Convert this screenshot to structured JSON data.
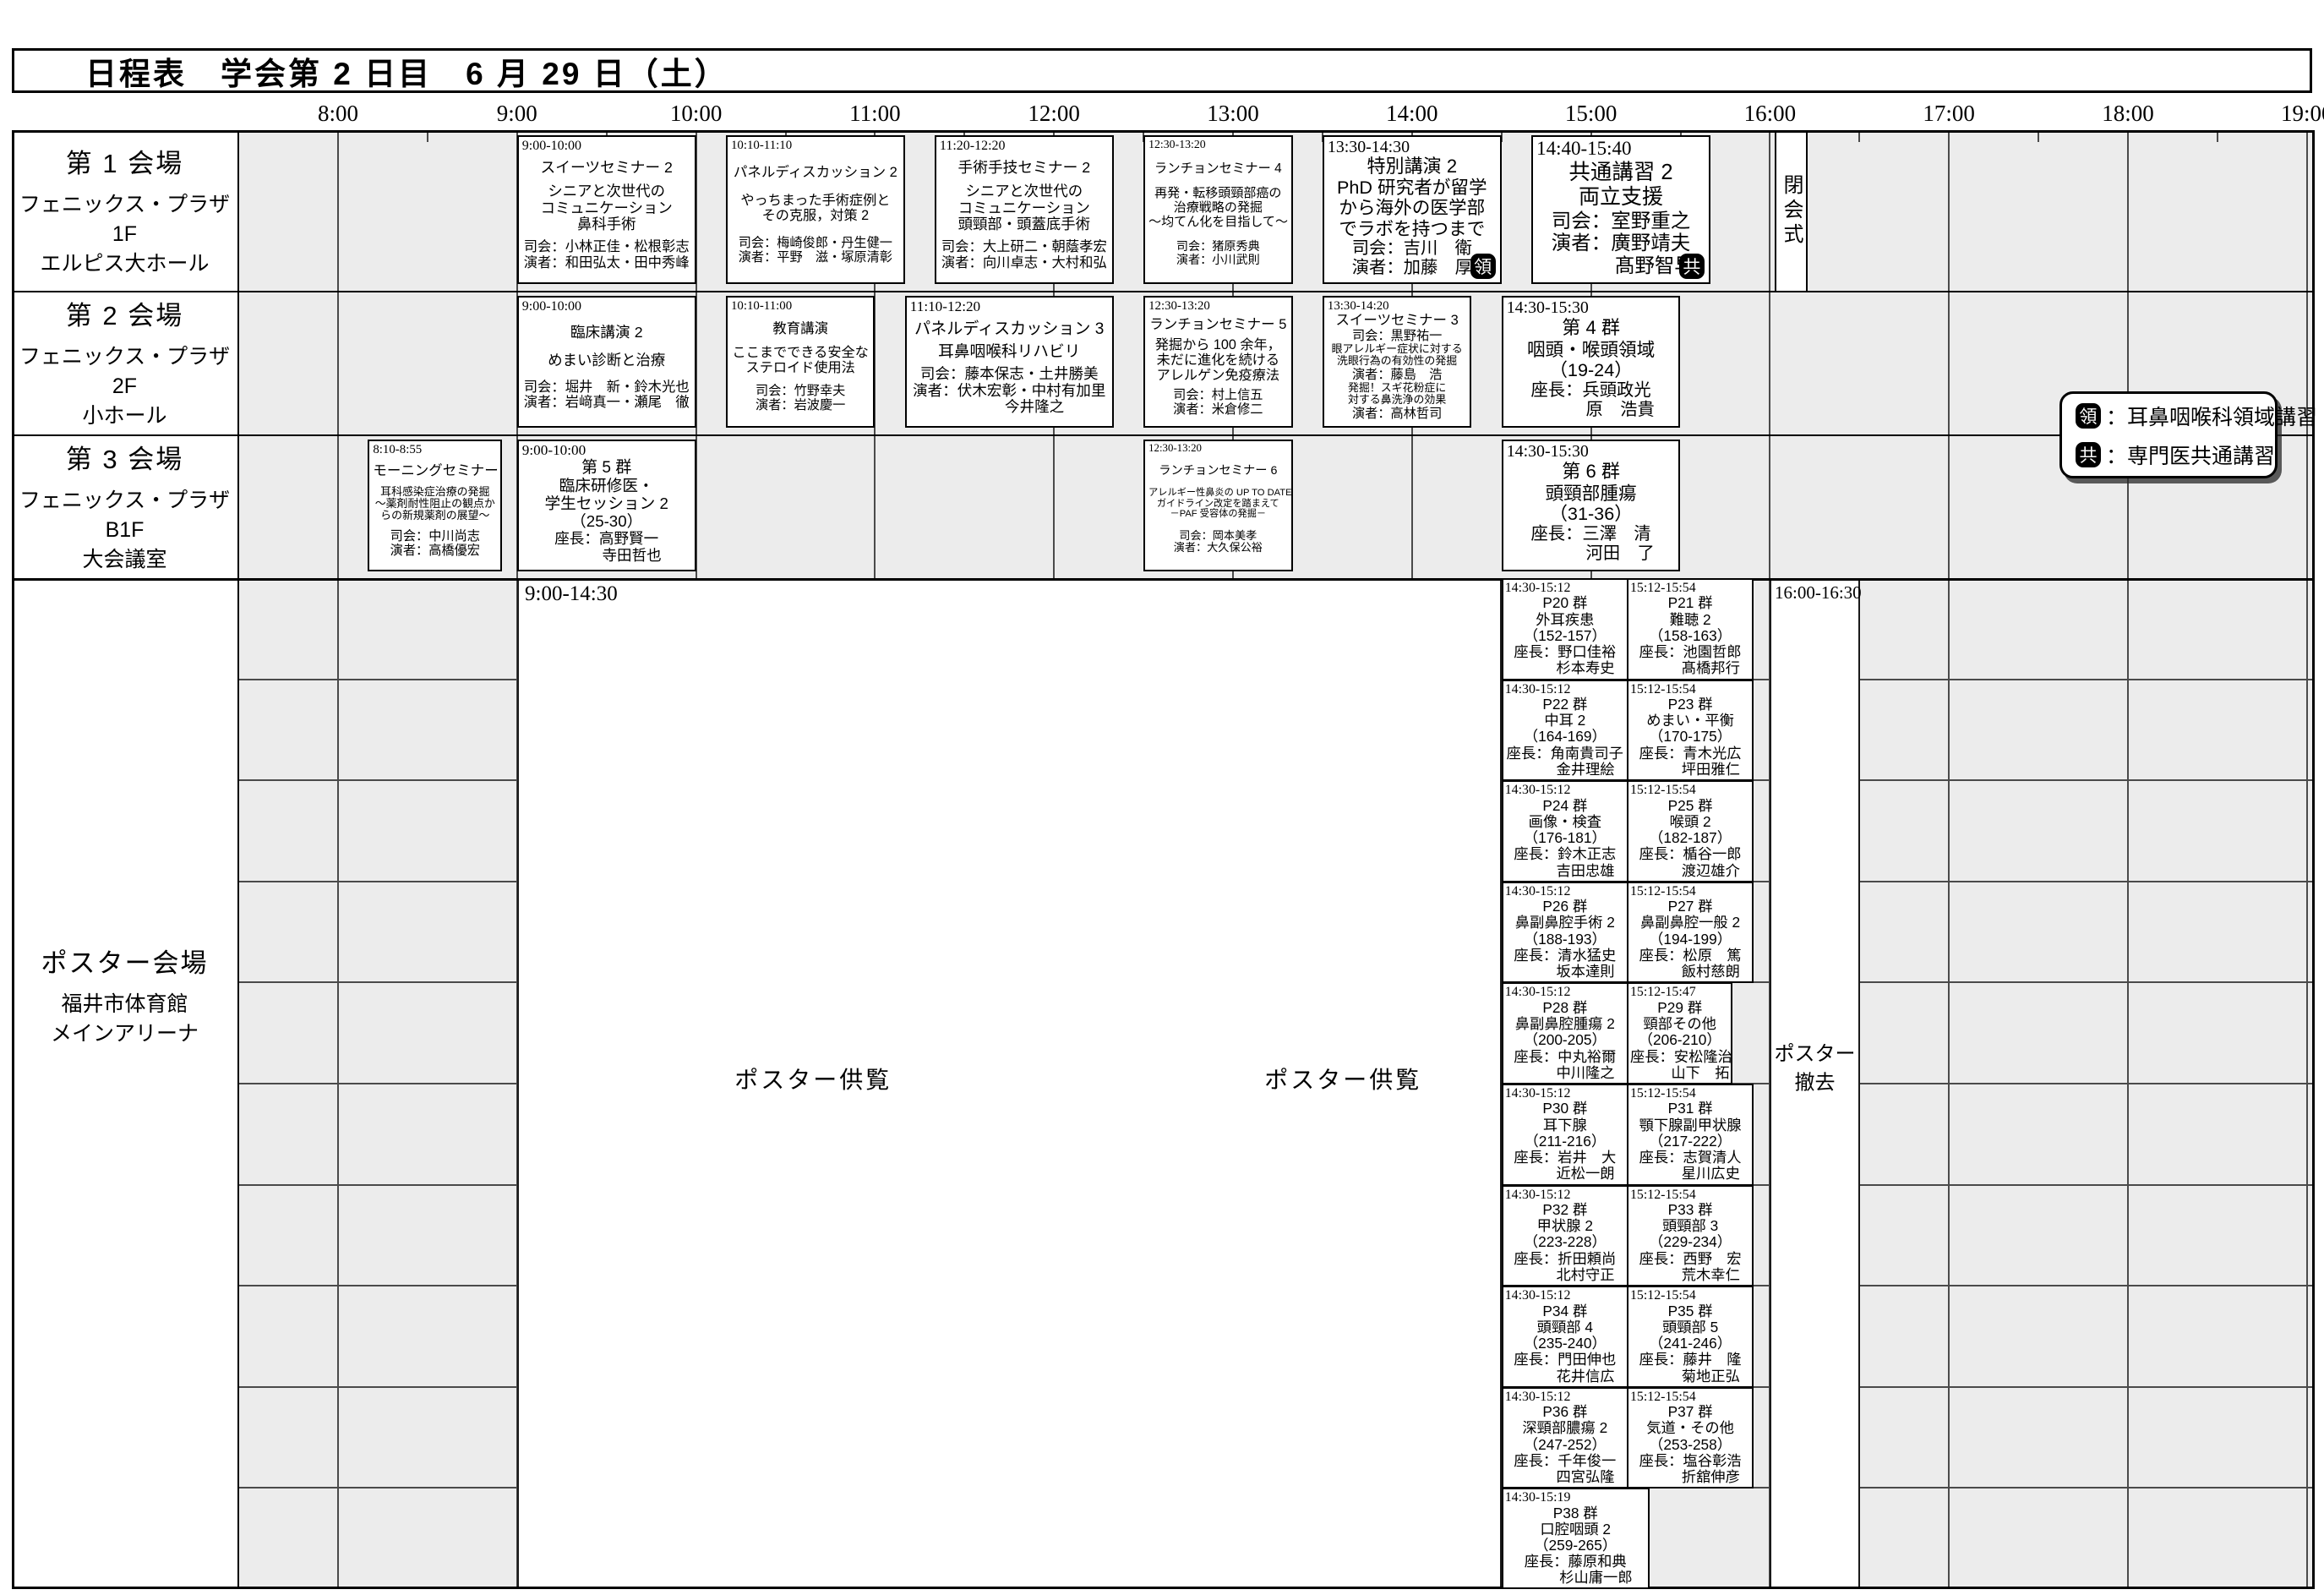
{
  "title": "日程表　学会第 2 日目　6 月 29 日（土）",
  "time_labels": [
    "8:00",
    "9:00",
    "10:00",
    "11:00",
    "12:00",
    "13:00",
    "14:00",
    "15:00",
    "16:00",
    "17:00",
    "18:00",
    "19:00"
  ],
  "closing": "閉会式",
  "legend": {
    "items": [
      {
        "badge": "領",
        "text": "：耳鼻咽喉科領域講習"
      },
      {
        "badge": "共",
        "text": "：専門医共通講習"
      }
    ]
  },
  "venues": [
    {
      "name": "第 1 会場",
      "floor": "フェニックス・プラザ 1F",
      "hall": "エルピス大ホール",
      "sessions": [
        {
          "time": "9:00-10:00",
          "start": 9.0,
          "end": 10.0,
          "lines": [
            {
              "t": "スイーツセミナー 2",
              "c": "name"
            },
            {
              "t": "シニアと次世代の",
              "c": "body"
            },
            {
              "t": "コミュニケーション",
              "c": "body"
            },
            {
              "t": "鼻科手術",
              "c": "body"
            },
            {
              "t": "司会：小林正佳・松根彰志",
              "c": "people"
            },
            {
              "t": "演者：和田弘太・田中秀峰",
              "c": "people"
            }
          ]
        },
        {
          "time": "10:10-11:10",
          "start": 10.167,
          "end": 11.167,
          "lines": [
            {
              "t": "パネルディスカッション 2",
              "c": "name"
            },
            {
              "t": "やっちまった手術症例と",
              "c": "body"
            },
            {
              "t": "その克服，対策 2",
              "c": "body"
            },
            {
              "t": "司会：梅崎俊郎・丹生健一",
              "c": "people"
            },
            {
              "t": "演者：平野　滋・塚原清彰",
              "c": "people"
            }
          ]
        },
        {
          "time": "11:20-12:20",
          "start": 11.333,
          "end": 12.333,
          "lines": [
            {
              "t": "手術手技セミナー 2",
              "c": "name"
            },
            {
              "t": "シニアと次世代の",
              "c": "body"
            },
            {
              "t": "コミュニケーション",
              "c": "body"
            },
            {
              "t": "頭頸部・頭蓋底手術",
              "c": "body"
            },
            {
              "t": "司会：大上研二・朝蔭孝宏",
              "c": "people"
            },
            {
              "t": "演者：向川卓志・大村和弘",
              "c": "people"
            }
          ]
        },
        {
          "time": "12:30-13:20",
          "start": 12.5,
          "end": 13.333,
          "lines": [
            {
              "t": "ランチョンセミナー 4",
              "c": "name"
            },
            {
              "t": "再発・転移頭頸部癌の",
              "c": "body"
            },
            {
              "t": "治療戦略の発掘",
              "c": "body"
            },
            {
              "t": "～均てん化を目指して～",
              "c": "body"
            },
            {
              "t": "司会：猪原秀典",
              "c": "people"
            },
            {
              "t": "演者：小川武則",
              "c": "people"
            }
          ]
        },
        {
          "time": "13:30-14:30",
          "start": 13.5,
          "end": 14.5,
          "badge": "領",
          "lines": [
            {
              "t": "特別講演 2",
              "c": "name"
            },
            {
              "t": "PhD 研究者が留学",
              "c": "body"
            },
            {
              "t": "から海外の医学部",
              "c": "body"
            },
            {
              "t": "でラボを持つまで",
              "c": "body"
            },
            {
              "t": "司会：吉川　衛",
              "c": "people"
            },
            {
              "t": "演者：加藤　厚",
              "c": "people"
            }
          ]
        },
        {
          "time": "14:40-15:40",
          "start": 14.667,
          "end": 15.667,
          "badge": "共",
          "lines": [
            {
              "t": "共通講習 2",
              "c": "name"
            },
            {
              "t": "両立支援",
              "c": "body"
            },
            {
              "t": "司会：室野重之",
              "c": "people"
            },
            {
              "t": "演者：廣野靖夫",
              "c": "people"
            },
            {
              "t": "髙野智早",
              "c": "p2"
            }
          ]
        }
      ]
    },
    {
      "name": "第 2 会場",
      "floor": "フェニックス・プラザ 2F",
      "hall": "小ホール",
      "sessions": [
        {
          "time": "9:00-10:00",
          "start": 9.0,
          "end": 10.0,
          "lines": [
            {
              "t": "臨床講演 2",
              "c": "name"
            },
            {
              "t": "めまい診断と治療",
              "c": "body"
            },
            {
              "t": "司会：堀井　新・鈴木光也",
              "c": "people"
            },
            {
              "t": "演者：岩﨑真一・瀬尾　徹",
              "c": "people"
            }
          ]
        },
        {
          "time": "10:10-11:00",
          "start": 10.167,
          "end": 11.0,
          "lines": [
            {
              "t": "教育講演",
              "c": "name"
            },
            {
              "t": "ここまでできる安全な",
              "c": "body"
            },
            {
              "t": "ステロイド使用法",
              "c": "body"
            },
            {
              "t": "司会：竹野幸夫",
              "c": "people"
            },
            {
              "t": "演者：岩波慶一",
              "c": "people"
            }
          ]
        },
        {
          "time": "11:10-12:20",
          "start": 11.167,
          "end": 12.333,
          "lines": [
            {
              "t": "パネルディスカッション 3",
              "c": "name"
            },
            {
              "t": "耳鼻咽喉科リハビリ",
              "c": "body"
            },
            {
              "t": "司会：藤本保志・土井勝美",
              "c": "people"
            },
            {
              "t": "演者：伏木宏彰・中村有加里",
              "c": "people"
            },
            {
              "t": "今井隆之",
              "c": "p2"
            }
          ]
        },
        {
          "time": "12:30-13:20",
          "start": 12.5,
          "end": 13.333,
          "lines": [
            {
              "t": "ランチョンセミナー 5",
              "c": "name"
            },
            {
              "t": "発掘から 100 余年，",
              "c": "body"
            },
            {
              "t": "未だに進化を続ける",
              "c": "body"
            },
            {
              "t": "アレルゲン免疫療法",
              "c": "body"
            },
            {
              "t": "司会：村上信五",
              "c": "people"
            },
            {
              "t": "演者：米倉修二",
              "c": "people"
            }
          ]
        },
        {
          "time": "13:30-14:20",
          "start": 13.5,
          "end": 14.333,
          "lines": [
            {
              "t": "スイーツセミナー 3",
              "c": "name"
            },
            {
              "t": "司会：黒野祐一",
              "c": "people"
            },
            {
              "t": "眼アレルギー症状に対する",
              "c": "small"
            },
            {
              "t": "洗眼行為の有効性の発掘",
              "c": "small"
            },
            {
              "t": "演者：藤島　浩",
              "c": "people"
            },
            {
              "t": "発掘！スギ花粉症に",
              "c": "small"
            },
            {
              "t": "対する鼻洗浄の効果",
              "c": "small"
            },
            {
              "t": "演者：高林哲司",
              "c": "people"
            }
          ]
        },
        {
          "time": "14:30-15:30",
          "start": 14.5,
          "end": 15.5,
          "lines": [
            {
              "t": "第 4 群",
              "c": "name"
            },
            {
              "t": "咽頭・喉頭領域",
              "c": "body"
            },
            {
              "t": "（19-24）",
              "c": "body"
            },
            {
              "t": "座長：兵頭政光",
              "c": "people"
            },
            {
              "t": "原　浩貴",
              "c": "p2"
            }
          ]
        }
      ]
    },
    {
      "name": "第 3 会場",
      "floor": "フェニックス・プラザ B1F",
      "hall": "大会議室",
      "sessions": [
        {
          "time": "8:10-8:55",
          "start": 8.167,
          "end": 8.917,
          "lines": [
            {
              "t": "モーニングセミナー",
              "c": "name"
            },
            {
              "t": "耳科感染症治療の発掘",
              "c": "small"
            },
            {
              "t": "～薬剤耐性阻止の観点か",
              "c": "small"
            },
            {
              "t": "らの新規薬剤の展望～",
              "c": "small"
            },
            {
              "t": "司会：中川尚志",
              "c": "people"
            },
            {
              "t": "演者：高橋優宏",
              "c": "people"
            }
          ]
        },
        {
          "time": "9:00-10:00",
          "start": 9.0,
          "end": 10.0,
          "lines": [
            {
              "t": "第 5 群",
              "c": "name"
            },
            {
              "t": "臨床研修医・",
              "c": "body"
            },
            {
              "t": "学生セッション 2",
              "c": "body"
            },
            {
              "t": "（25-30）",
              "c": "body"
            },
            {
              "t": "座長：高野賢一",
              "c": "people"
            },
            {
              "t": "寺田哲也",
              "c": "p2"
            }
          ]
        },
        {
          "time": "12:30-13:20",
          "start": 12.5,
          "end": 13.333,
          "lines": [
            {
              "t": "ランチョンセミナー 6",
              "c": "name"
            },
            {
              "t": "アレルギー性鼻炎の UP TO DATE",
              "c": "small"
            },
            {
              "t": "ガイドライン改定を踏まえて",
              "c": "small"
            },
            {
              "t": "－PAF 受容体の発掘－",
              "c": "small"
            },
            {
              "t": "司会：岡本美孝",
              "c": "people"
            },
            {
              "t": "演者：大久保公裕",
              "c": "people"
            }
          ]
        },
        {
          "time": "14:30-15:30",
          "start": 14.5,
          "end": 15.5,
          "lines": [
            {
              "t": "第 6 群",
              "c": "name"
            },
            {
              "t": "頭頸部腫瘍",
              "c": "body"
            },
            {
              "t": "（31-36）",
              "c": "body"
            },
            {
              "t": "座長：三澤　清",
              "c": "people"
            },
            {
              "t": "河田　了",
              "c": "p2"
            }
          ]
        }
      ]
    }
  ],
  "poster": {
    "name": "ポスター会場",
    "sub1": "福井市体育館",
    "sub2": "メインアリーナ",
    "viewing": {
      "time": "9:00-14:30",
      "label": "ポスター供覧"
    },
    "removal": {
      "time": "16:00-16:30",
      "label": "ポスター撤去"
    },
    "groups": [
      {
        "time": "14:30-15:12",
        "start": 14.5,
        "end": 15.2,
        "row": 0,
        "lines": [
          "P20 群",
          "外耳疾患",
          "（152-157）",
          "座長：野口佳裕",
          "杉本寿史"
        ]
      },
      {
        "time": "15:12-15:54",
        "start": 15.2,
        "end": 15.9,
        "row": 0,
        "lines": [
          "P21 群",
          "難聴 2",
          "（158-163）",
          "座長：池園哲郎",
          "髙橋邦行"
        ]
      },
      {
        "time": "14:30-15:12",
        "start": 14.5,
        "end": 15.2,
        "row": 1,
        "lines": [
          "P22 群",
          "中耳 2",
          "（164-169）",
          "座長：角南貴司子",
          "金井理絵"
        ]
      },
      {
        "time": "15:12-15:54",
        "start": 15.2,
        "end": 15.9,
        "row": 1,
        "lines": [
          "P23 群",
          "めまい・平衡",
          "（170-175）",
          "座長：青木光広",
          "坪田雅仁"
        ]
      },
      {
        "time": "14:30-15:12",
        "start": 14.5,
        "end": 15.2,
        "row": 2,
        "lines": [
          "P24 群",
          "画像・検査",
          "（176-181）",
          "座長：鈴木正志",
          "吉田忠雄"
        ]
      },
      {
        "time": "15:12-15:54",
        "start": 15.2,
        "end": 15.9,
        "row": 2,
        "lines": [
          "P25 群",
          "喉頭 2",
          "（182-187）",
          "座長：楯谷一郎",
          "渡辺雄介"
        ]
      },
      {
        "time": "14:30-15:12",
        "start": 14.5,
        "end": 15.2,
        "row": 3,
        "lines": [
          "P26 群",
          "鼻副鼻腔手術 2",
          "（188-193）",
          "座長：清水猛史",
          "坂本達則"
        ]
      },
      {
        "time": "15:12-15:54",
        "start": 15.2,
        "end": 15.9,
        "row": 3,
        "lines": [
          "P27 群",
          "鼻副鼻腔一般 2",
          "（194-199）",
          "座長：松原　篤",
          "飯村慈朗"
        ]
      },
      {
        "time": "14:30-15:12",
        "start": 14.5,
        "end": 15.2,
        "row": 4,
        "lines": [
          "P28 群",
          "鼻副鼻腔腫瘍 2",
          "（200-205）",
          "座長：中丸裕爾",
          "中川隆之"
        ]
      },
      {
        "time": "15:12-15:47",
        "start": 15.2,
        "end": 15.783,
        "row": 4,
        "lines": [
          "P29 群",
          "頸部その他",
          "（206-210）",
          "座長：安松隆治",
          "山下　拓"
        ]
      },
      {
        "time": "14:30-15:12",
        "start": 14.5,
        "end": 15.2,
        "row": 5,
        "lines": [
          "P30 群",
          "耳下腺",
          "（211-216）",
          "座長：岩井　大",
          "近松一朗"
        ]
      },
      {
        "time": "15:12-15:54",
        "start": 15.2,
        "end": 15.9,
        "row": 5,
        "lines": [
          "P31 群",
          "顎下腺副甲状腺",
          "（217-222）",
          "座長：志賀清人",
          "星川広史"
        ]
      },
      {
        "time": "14:30-15:12",
        "start": 14.5,
        "end": 15.2,
        "row": 6,
        "lines": [
          "P32 群",
          "甲状腺 2",
          "（223-228）",
          "座長：折田頼尚",
          "北村守正"
        ]
      },
      {
        "time": "15:12-15:54",
        "start": 15.2,
        "end": 15.9,
        "row": 6,
        "lines": [
          "P33 群",
          "頭頸部 3",
          "（229-234）",
          "座長：西野　宏",
          "荒木幸仁"
        ]
      },
      {
        "time": "14:30-15:12",
        "start": 14.5,
        "end": 15.2,
        "row": 7,
        "lines": [
          "P34 群",
          "頭頸部 4",
          "（235-240）",
          "座長：門田伸也",
          "花井信広"
        ]
      },
      {
        "time": "15:12-15:54",
        "start": 15.2,
        "end": 15.9,
        "row": 7,
        "lines": [
          "P35 群",
          "頭頸部 5",
          "（241-246）",
          "座長：藤井　隆",
          "菊地正弘"
        ]
      },
      {
        "time": "14:30-15:12",
        "start": 14.5,
        "end": 15.2,
        "row": 8,
        "lines": [
          "P36 群",
          "深頸部膿瘍 2",
          "（247-252）",
          "座長：千年俊一",
          "四宮弘隆"
        ]
      },
      {
        "time": "15:12-15:54",
        "start": 15.2,
        "end": 15.9,
        "row": 8,
        "lines": [
          "P37 群",
          "気道・その他",
          "（253-258）",
          "座長：塩谷彰浩",
          "折舘伸彦"
        ]
      },
      {
        "time": "14:30-15:19",
        "start": 14.5,
        "end": 15.317,
        "row": 9,
        "lines": [
          "P38 群",
          "口腔咽頭 2",
          "（259-265）",
          "座長：藤原和典",
          "杉山庸一郎"
        ]
      }
    ]
  }
}
